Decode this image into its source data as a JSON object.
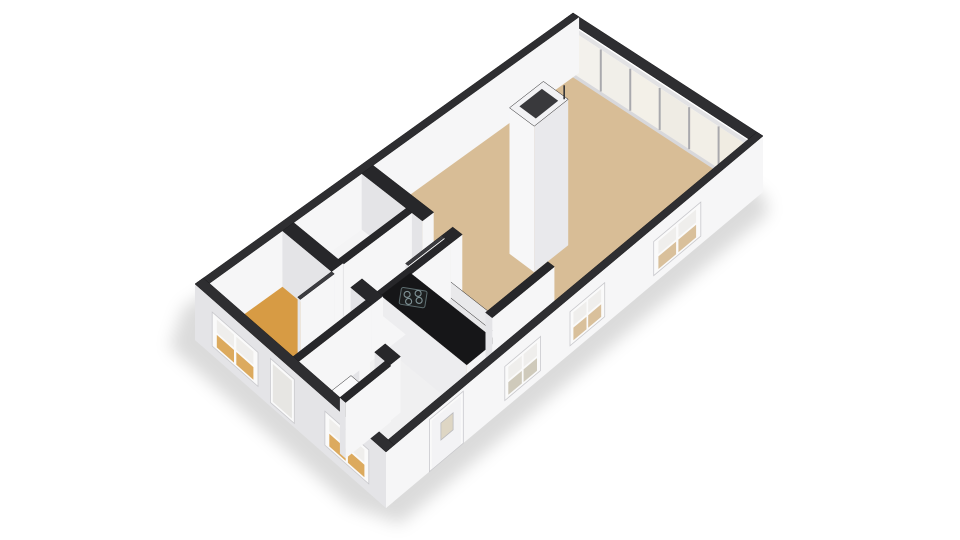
{
  "scene": {
    "background": "#ffffff",
    "projection": {
      "corners": {
        "N": [
          573,
          13
        ],
        "E": [
          763,
          136
        ],
        "S": [
          386,
          452
        ],
        "W": [
          195,
          284
        ]
      },
      "wall_drop": 56,
      "floor_drop": 50
    },
    "palette": {
      "cap_exterior": "#2e2e31",
      "cap_interior": "#27272a",
      "face_bright": "#f6f6f7",
      "face_dark": "#e4e4e7",
      "floor_living": "#d8bd96",
      "floor_bedroom": "#d79b44",
      "floor_white": "#f1f1f2",
      "floor_service": "#f4f4f5",
      "floor_corridor": "#ededef",
      "floor_hall": "#f0f0f1",
      "counter_top": "#161618",
      "bar_top": "#e9e9eb",
      "glass_pane": "#f2f0ea",
      "window_frame": "#fafafa",
      "shadow": "rgba(0,0,0,0.14)"
    },
    "shadow": {
      "points": [
        [
          553,
          70
        ],
        [
          765,
          196
        ],
        [
          768,
          214
        ],
        [
          400,
          524
        ],
        [
          350,
          506
        ],
        [
          170,
          347
        ],
        [
          183,
          308
        ]
      ],
      "blur": 8,
      "color": "rgba(0,0,0,0.14)"
    },
    "floors": [
      {
        "name": "floor-base",
        "rect": [
          0.032,
          0.022,
          0.968,
          0.978
        ],
        "fill": "#f1f1f2"
      },
      {
        "name": "floor-living-room",
        "rect": [
          0.032,
          0.022,
          0.968,
          0.7
        ],
        "fill": "#d8bd96"
      },
      {
        "name": "floor-corridor",
        "rect": [
          0.3,
          0.695,
          0.968,
          0.755
        ],
        "fill": "#ededef"
      },
      {
        "name": "floor-bathroom",
        "rect": [
          0.032,
          0.575,
          0.265,
          0.755
        ],
        "fill": "#f4f4f5"
      },
      {
        "name": "floor-bathroom-2",
        "rect": [
          0.295,
          0.575,
          0.47,
          0.755
        ],
        "fill": "#f4f4f5"
      },
      {
        "name": "floor-hall",
        "rect": [
          0.5,
          0.755,
          0.968,
          0.978
        ],
        "fill": "#f0f0f1"
      },
      {
        "name": "floor-bedroom",
        "rect": [
          0.032,
          0.785,
          0.47,
          0.978
        ],
        "fill": "#d79b44"
      }
    ],
    "glass_wall": {
      "name": "glass-window-wall",
      "u0": 0.035,
      "u1": 0.965,
      "v": 0.022,
      "y_top": 2,
      "y_rail": 7,
      "y_sill": 49,
      "y_bottom": 53,
      "panel_colors": [
        "#f3f1ec",
        "#f1efe9",
        "#f3f0e8",
        "#efece4",
        "#f2efe7",
        "#f0ece2"
      ],
      "mullion": "#a9a9ad",
      "rail": "#e2e2e4",
      "sill": "#d8d8db"
    },
    "prisms": [
      {
        "name": "exterior-wall-ne",
        "rect": [
          0.0,
          0.0,
          1.0,
          0.022
        ],
        "cap": "#2e2e31",
        "no_faces": true
      },
      {
        "name": "exterior-wall-nw",
        "rect": [
          0.0,
          0.0,
          0.032,
          1.0
        ],
        "cap": "#2e2e31"
      },
      {
        "name": "exterior-wall-se",
        "rect": [
          0.968,
          0.0,
          1.0,
          1.0
        ],
        "cap": "#2e2e31",
        "openings_edge": [
          "E",
          "S"
        ],
        "openings": [
          {
            "type": "window",
            "name": "facade-window",
            "t0": 0.165,
            "t1": 0.29,
            "y0": 14,
            "y1": 48,
            "lower": "#d9c09b"
          },
          {
            "type": "window",
            "name": "facade-window",
            "t0": 0.42,
            "t1": 0.512,
            "y0": 14,
            "y1": 48,
            "lower": "#d9c09b"
          },
          {
            "type": "window",
            "name": "facade-window",
            "t0": 0.59,
            "t1": 0.685,
            "y0": 14,
            "y1": 48,
            "lower": "#cfcabb"
          },
          {
            "type": "door",
            "name": "front-door",
            "t0": 0.795,
            "t1": 0.885,
            "y0": 4,
            "y1": 56,
            "pane": "#ded6c4"
          }
        ]
      },
      {
        "name": "exterior-wall-sw",
        "rect": [
          0.0,
          0.978,
          1.0,
          1.0
        ],
        "cap": "#2e2e31",
        "openings_edge": [
          "W",
          "S"
        ],
        "openings": [
          {
            "type": "window",
            "name": "facade-window",
            "t0": 0.09,
            "t1": 0.33,
            "y0": 13,
            "y1": 47,
            "lower": "#dcaa5e"
          },
          {
            "type": "narrow",
            "name": "facade-window-narrow",
            "t0": 0.395,
            "t1": 0.52,
            "y0": 8,
            "y1": 52,
            "pane": "#e7e6e3"
          },
          {
            "type": "window",
            "name": "facade-window",
            "t0": 0.68,
            "t1": 0.91,
            "y0": 13,
            "y1": 47,
            "lower": "#dcaa5e"
          }
        ]
      },
      {
        "name": "wall-cross-a",
        "rect": [
          0.032,
          0.545,
          0.35,
          0.575
        ],
        "cap": "#27272a"
      },
      {
        "name": "wall-cross-b",
        "rect": [
          0.45,
          0.545,
          0.5,
          0.575
        ],
        "cap": "#27272a"
      },
      {
        "name": "wall-spine",
        "rect": [
          0.47,
          0.575,
          0.5,
          0.755
        ],
        "cap": "#27272a"
      },
      {
        "name": "wall-bath-divider",
        "rect": [
          0.265,
          0.575,
          0.295,
          0.755
        ],
        "cap": "#27272a"
      },
      {
        "name": "wall-bedroom-a",
        "rect": [
          0.032,
          0.755,
          0.29,
          0.785
        ],
        "cap": "#27272a"
      },
      {
        "name": "wall-bedroom-b",
        "rect": [
          0.39,
          0.755,
          0.5,
          0.785
        ],
        "cap": "#27272a"
      },
      {
        "name": "wall-hall-west",
        "rect": [
          0.47,
          0.785,
          0.5,
          0.978
        ],
        "cap": "#27272a"
      },
      {
        "name": "wall-toilet-north-a",
        "rect": [
          0.5,
          0.83,
          0.58,
          0.858
        ],
        "cap": "#27272a"
      },
      {
        "name": "wall-toilet-north-b",
        "rect": [
          0.66,
          0.83,
          0.74,
          0.858
        ],
        "cap": "#27272a"
      },
      {
        "name": "wall-toilet-east",
        "rect": [
          0.715,
          0.858,
          0.745,
          0.978
        ],
        "cap": "#27272a"
      },
      {
        "name": "wall-stub-kitchen",
        "rect": [
          0.82,
          0.48,
          0.855,
          0.645
        ],
        "cap": "#27272a"
      },
      {
        "name": "door-leaf",
        "rect": [
          0.45,
          0.575,
          0.464,
          0.67
        ],
        "cap": "#3c3c40"
      },
      {
        "name": "door-leaf",
        "rect": [
          0.29,
          0.785,
          0.304,
          0.875
        ],
        "cap": "#3c3c40"
      },
      {
        "name": "kitchen-bar",
        "rect": [
          0.37,
          0.59,
          0.82,
          0.617
        ],
        "top": 30,
        "cap": "#e9e9eb",
        "faces": {
          "pos": "#f2f2f3",
          "neg": "#e7e7e9"
        }
      },
      {
        "name": "kitchen-counter",
        "rect": [
          0.37,
          0.617,
          0.82,
          0.695
        ],
        "top": 37,
        "cap": "#161618",
        "faces": {
          "pos": "#f4f4f5",
          "neg": "#ededef"
        }
      },
      {
        "name": "toilet-fixture",
        "rect": [
          0.56,
          0.87,
          0.66,
          0.94
        ],
        "top": 36,
        "cap": "#fafafb",
        "faces": {
          "pos": "#f2f2f4",
          "neg": "#e9e9eb"
        }
      },
      {
        "name": "chimney",
        "rect": [
          0.5,
          0.33,
          0.63,
          0.42
        ],
        "top": -90,
        "cap": "#f2f2f4",
        "chimney": true,
        "inner": "#39393c",
        "faces": {
          "pos": "#e9e9ec",
          "neg": "#f7f7f8"
        }
      }
    ],
    "hob": {
      "name": "stove-hob-icon",
      "u": 0.46,
      "v": 0.655,
      "surface_offset": 37,
      "body": "#1d1f20",
      "ring": "#7f9296",
      "w": 26,
      "h": 17
    },
    "antenna": {
      "name": "chimney-antenna",
      "color": "#333336",
      "height": 14
    }
  }
}
